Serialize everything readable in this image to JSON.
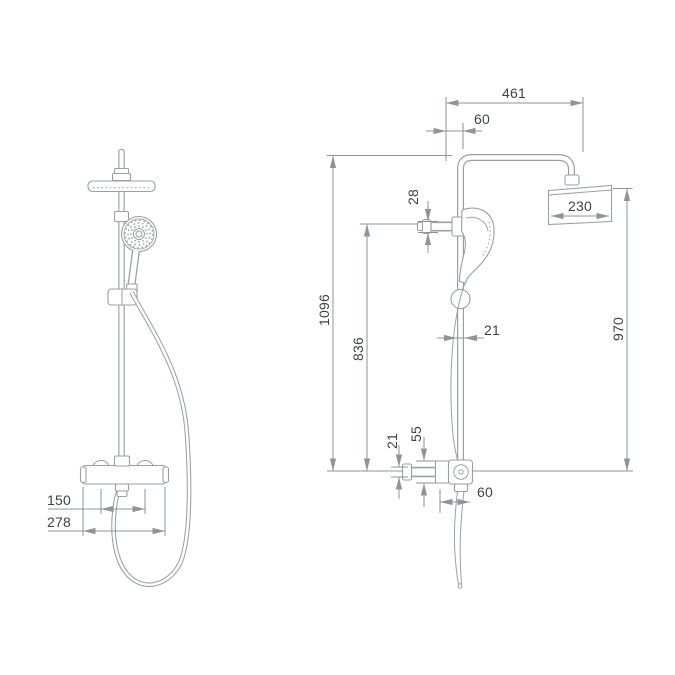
{
  "drawing": {
    "background": "#ffffff",
    "line_color": "#9aa0a5",
    "dim_line_color": "#8f9499",
    "text_color": "#3f4245",
    "front_view": {
      "dims": {
        "handle_spacing": "150",
        "valve_body_width": "278"
      }
    },
    "side_view": {
      "dims": {
        "arm_reach": "461",
        "arm_offset": "60",
        "holder_depth": "28",
        "total_height": "1096",
        "holder_height": "836",
        "pipe_width": "21",
        "head_height": "970",
        "head_width": "230",
        "supply_pipe_width": "21",
        "valve_height": "55",
        "outlet_offset": "60"
      }
    }
  }
}
